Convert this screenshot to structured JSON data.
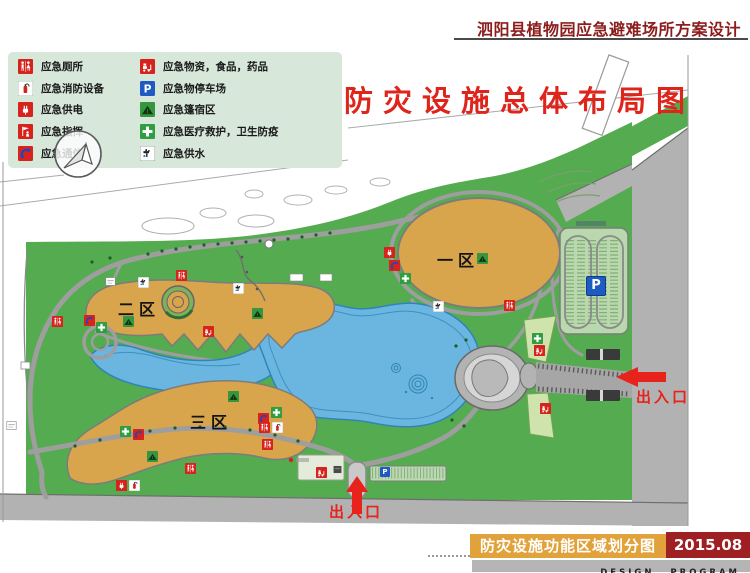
{
  "header": {
    "title": "泗阳县植物园应急避难场所方案设计"
  },
  "map": {
    "title": "防灾设施总体布局图",
    "parking_label": "P",
    "mini_parking_label": "P",
    "districts": [
      {
        "label": "一区",
        "x": 437,
        "y": 247
      },
      {
        "label": "二区",
        "x": 118,
        "y": 296
      },
      {
        "label": "三区",
        "x": 190,
        "y": 409
      }
    ],
    "entrances": [
      {
        "label": "出入口",
        "x": 636,
        "y": 386
      },
      {
        "label": "出入口",
        "x": 329,
        "y": 501
      }
    ],
    "markers": [
      {
        "type": "power",
        "x": 389,
        "y": 248
      },
      {
        "type": "phone",
        "x": 394,
        "y": 261
      },
      {
        "type": "medical",
        "x": 405,
        "y": 274
      },
      {
        "type": "tent",
        "x": 482,
        "y": 254
      },
      {
        "type": "water",
        "x": 438,
        "y": 302
      },
      {
        "type": "toilet",
        "x": 509,
        "y": 301
      },
      {
        "type": "toilet",
        "x": 181,
        "y": 271
      },
      {
        "type": "sign-white",
        "x": 110,
        "y": 277
      },
      {
        "type": "water",
        "x": 143,
        "y": 278
      },
      {
        "type": "water",
        "x": 238,
        "y": 284
      },
      {
        "type": "phone",
        "x": 89,
        "y": 316
      },
      {
        "type": "medical",
        "x": 101,
        "y": 323
      },
      {
        "type": "tent",
        "x": 128,
        "y": 317
      },
      {
        "type": "supplies",
        "x": 208,
        "y": 327
      },
      {
        "type": "tent",
        "x": 257,
        "y": 309
      },
      {
        "type": "toilet",
        "x": 57,
        "y": 317
      },
      {
        "type": "tent",
        "x": 233,
        "y": 392
      },
      {
        "type": "medical",
        "x": 125,
        "y": 427
      },
      {
        "type": "phone",
        "x": 138,
        "y": 430
      },
      {
        "type": "medical",
        "x": 276,
        "y": 408
      },
      {
        "type": "phone",
        "x": 263,
        "y": 414
      },
      {
        "type": "toilet",
        "x": 264,
        "y": 423
      },
      {
        "type": "fire",
        "x": 277,
        "y": 423
      },
      {
        "type": "toilet",
        "x": 267,
        "y": 440
      },
      {
        "type": "tent",
        "x": 152,
        "y": 452
      },
      {
        "type": "toilet",
        "x": 190,
        "y": 464
      },
      {
        "type": "power",
        "x": 121,
        "y": 481
      },
      {
        "type": "fire",
        "x": 134,
        "y": 481
      },
      {
        "type": "supplies",
        "x": 321,
        "y": 468
      },
      {
        "type": "sign-dark",
        "x": 337,
        "y": 465
      },
      {
        "type": "medical",
        "x": 537,
        "y": 334
      },
      {
        "type": "supplies",
        "x": 539,
        "y": 346
      },
      {
        "type": "supplies",
        "x": 545,
        "y": 404
      },
      {
        "type": "sign-white",
        "x": 11,
        "y": 421
      }
    ]
  },
  "legend": {
    "left": [
      {
        "type": "toilet",
        "label": "应急厕所"
      },
      {
        "type": "fire",
        "label": "应急消防设备"
      },
      {
        "type": "power",
        "label": "应急供电"
      },
      {
        "type": "command",
        "label": "应急指挥"
      },
      {
        "type": "phone",
        "label": "应急通信"
      }
    ],
    "right": [
      {
        "type": "supplies",
        "label": "应急物资，食品，药品"
      },
      {
        "type": "parking",
        "label": "应急物停车场"
      },
      {
        "type": "tent",
        "label": "应急篷宿区"
      },
      {
        "type": "medical",
        "label": "应急医疗救护，卫生防疫"
      },
      {
        "type": "water",
        "label": "应急供水"
      }
    ]
  },
  "footer": {
    "caption": "防灾设施功能区域划分图",
    "date": "2015.08",
    "credit": "DESIGN PROGRAM"
  },
  "colors": {
    "accent_red": "#e8231c",
    "title_red": "#de241b",
    "header_maroon": "#8c1d1d",
    "park_green": "#55ab4f",
    "district_orange": "#d9a54c",
    "lake_blue": "#6ab6e0",
    "road_gray": "#b2b2b2",
    "footer_orange": "#e2a23b",
    "footer_date_red": "#9e2022",
    "parking_blue": "#1d5ac2"
  }
}
